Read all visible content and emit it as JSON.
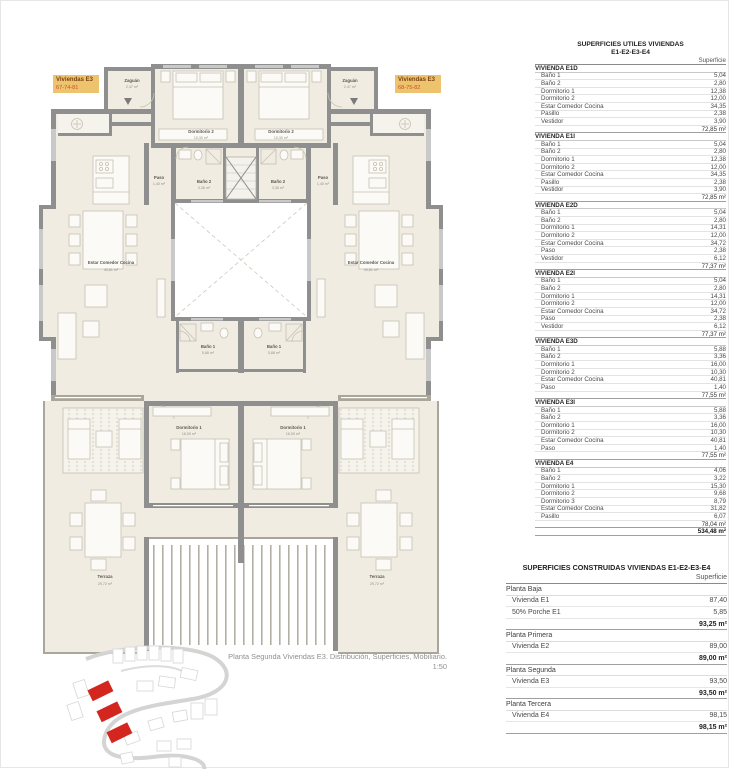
{
  "colors": {
    "label_bg": "#eec36d",
    "label_title": "#7a4315",
    "label_numbers": "#c8502b",
    "site_red": "#d3261f",
    "wall": "#8f8f8f",
    "floor": "#f0ece2"
  },
  "plan": {
    "unit_labels": {
      "left": {
        "title": "Viviendas E3",
        "numbers": "67-74-81"
      },
      "right": {
        "title": "Viviendas E3",
        "numbers": "68-75-82"
      }
    },
    "rooms": {
      "zaguan": {
        "name": "Zaguán",
        "area": "2,47 m²"
      },
      "dormitorio2": {
        "name": "Dormitorio 2",
        "area": "10,30 m²"
      },
      "paso": {
        "name": "Paso",
        "area": "1,40 m²"
      },
      "bano2": {
        "name": "Baño 2",
        "area": "3,36 m²"
      },
      "estar": {
        "name": "Estar Comedor Cocina",
        "area": "40,81 m²"
      },
      "bano1": {
        "name": "Baño 1",
        "area": "5,88 m²"
      },
      "dormitorio1": {
        "name": "Dormitorio 1",
        "area": "16,00 m²"
      },
      "terraza": {
        "name": "Terraza",
        "area": "29,72 m²"
      }
    },
    "caption": {
      "line1": "Planta Segunda Viviendas E3. Distribución, Superficies, Mobiliario.",
      "line2": "1:50"
    }
  },
  "tables": {
    "utiles": {
      "title_line1": "SUPERFICIES UTILES VIVIENDAS",
      "title_line2": "E1-E2-E3-E4",
      "col_header": "Superficie",
      "sections": [
        {
          "name": "VIVIENDA E1D",
          "rows": [
            [
              "Baño 1",
              "5,04"
            ],
            [
              "Baño 2",
              "2,80"
            ],
            [
              "Dormitorio 1",
              "12,38"
            ],
            [
              "Dormitorio 2",
              "12,00"
            ],
            [
              "Estar Comedor Cocina",
              "34,35"
            ],
            [
              "Pasillo",
              "2,38"
            ],
            [
              "Vestidor",
              "3,90"
            ]
          ],
          "total": "72,85 m²"
        },
        {
          "name": "VIVIENDA E1I",
          "rows": [
            [
              "Baño 1",
              "5,04"
            ],
            [
              "Baño 2",
              "2,80"
            ],
            [
              "Dormitorio 1",
              "12,38"
            ],
            [
              "Dormitorio 2",
              "12,00"
            ],
            [
              "Estar Comedor Cocina",
              "34,35"
            ],
            [
              "Pasillo",
              "2,38"
            ],
            [
              "Vestidor",
              "3,90"
            ]
          ],
          "total": "72,85 m²"
        },
        {
          "name": "VIVIENDA E2D",
          "rows": [
            [
              "Baño 1",
              "5,04"
            ],
            [
              "Baño 2",
              "2,80"
            ],
            [
              "Dormitorio 1",
              "14,31"
            ],
            [
              "Dormitorio 2",
              "12,00"
            ],
            [
              "Estar Comedor Cocina",
              "34,72"
            ],
            [
              "Paso",
              "2,38"
            ],
            [
              "Vestidor",
              "6,12"
            ]
          ],
          "total": "77,37 m²"
        },
        {
          "name": "VIVIENDA E2I",
          "rows": [
            [
              "Baño 1",
              "5,04"
            ],
            [
              "Baño 2",
              "2,80"
            ],
            [
              "Dormitorio 1",
              "14,31"
            ],
            [
              "Dormitorio 2",
              "12,00"
            ],
            [
              "Estar Comedor Cocina",
              "34,72"
            ],
            [
              "Paso",
              "2,38"
            ],
            [
              "Vestidor",
              "6,12"
            ]
          ],
          "total": "77,37 m²"
        },
        {
          "name": "VIVIENDA E3D",
          "rows": [
            [
              "Baño 1",
              "5,88"
            ],
            [
              "Baño 2",
              "3,36"
            ],
            [
              "Dormitorio 1",
              "16,00"
            ],
            [
              "Dormitorio 2",
              "10,30"
            ],
            [
              "Estar Comedor Cocina",
              "40,81"
            ],
            [
              "Paso",
              "1,40"
            ]
          ],
          "total": "77,55 m²"
        },
        {
          "name": "VIVIENDA E3I",
          "rows": [
            [
              "Baño 1",
              "5,88"
            ],
            [
              "Baño 2",
              "3,36"
            ],
            [
              "Dormitorio 1",
              "16,00"
            ],
            [
              "Dormitorio 2",
              "10,30"
            ],
            [
              "Estar Comedor Cocina",
              "40,81"
            ],
            [
              "Paso",
              "1,40"
            ]
          ],
          "total": "77,55 m²"
        },
        {
          "name": "VIVIENDA E4",
          "rows": [
            [
              "Baño 1",
              "4,06"
            ],
            [
              "Baño 2",
              "3,22"
            ],
            [
              "Dormitorio 1",
              "15,30"
            ],
            [
              "Dormitorio 2",
              "9,68"
            ],
            [
              "Dormitorio 3",
              "8,79"
            ],
            [
              "Estar Comedor Cocina",
              "31,82"
            ],
            [
              "Pasillo",
              "6,07"
            ]
          ],
          "total": "78,04 m²"
        }
      ],
      "grand_total": "534,48 m²"
    },
    "construidas": {
      "title": "SUPERFICIES CONSTRUIDAS VIVIENDAS E1-E2-E3-E4",
      "col_header": "Superficie",
      "groups": [
        {
          "name": "Planta Baja",
          "rows": [
            [
              "Vivienda E1",
              "87,40"
            ],
            [
              "50% Porche E1",
              "5,85"
            ]
          ],
          "total": "93,25 m²"
        },
        {
          "name": "Planta Primera",
          "rows": [
            [
              "Vivienda E2",
              "89,00"
            ]
          ],
          "total": "89,00 m²"
        },
        {
          "name": "Planta Segunda",
          "rows": [
            [
              "Vivienda E3",
              "93,50"
            ]
          ],
          "total": "93,50 m²"
        },
        {
          "name": "Planta Tercera",
          "rows": [
            [
              "Vivienda E4",
              "98,15"
            ]
          ],
          "total": "98,15 m²"
        }
      ]
    }
  }
}
